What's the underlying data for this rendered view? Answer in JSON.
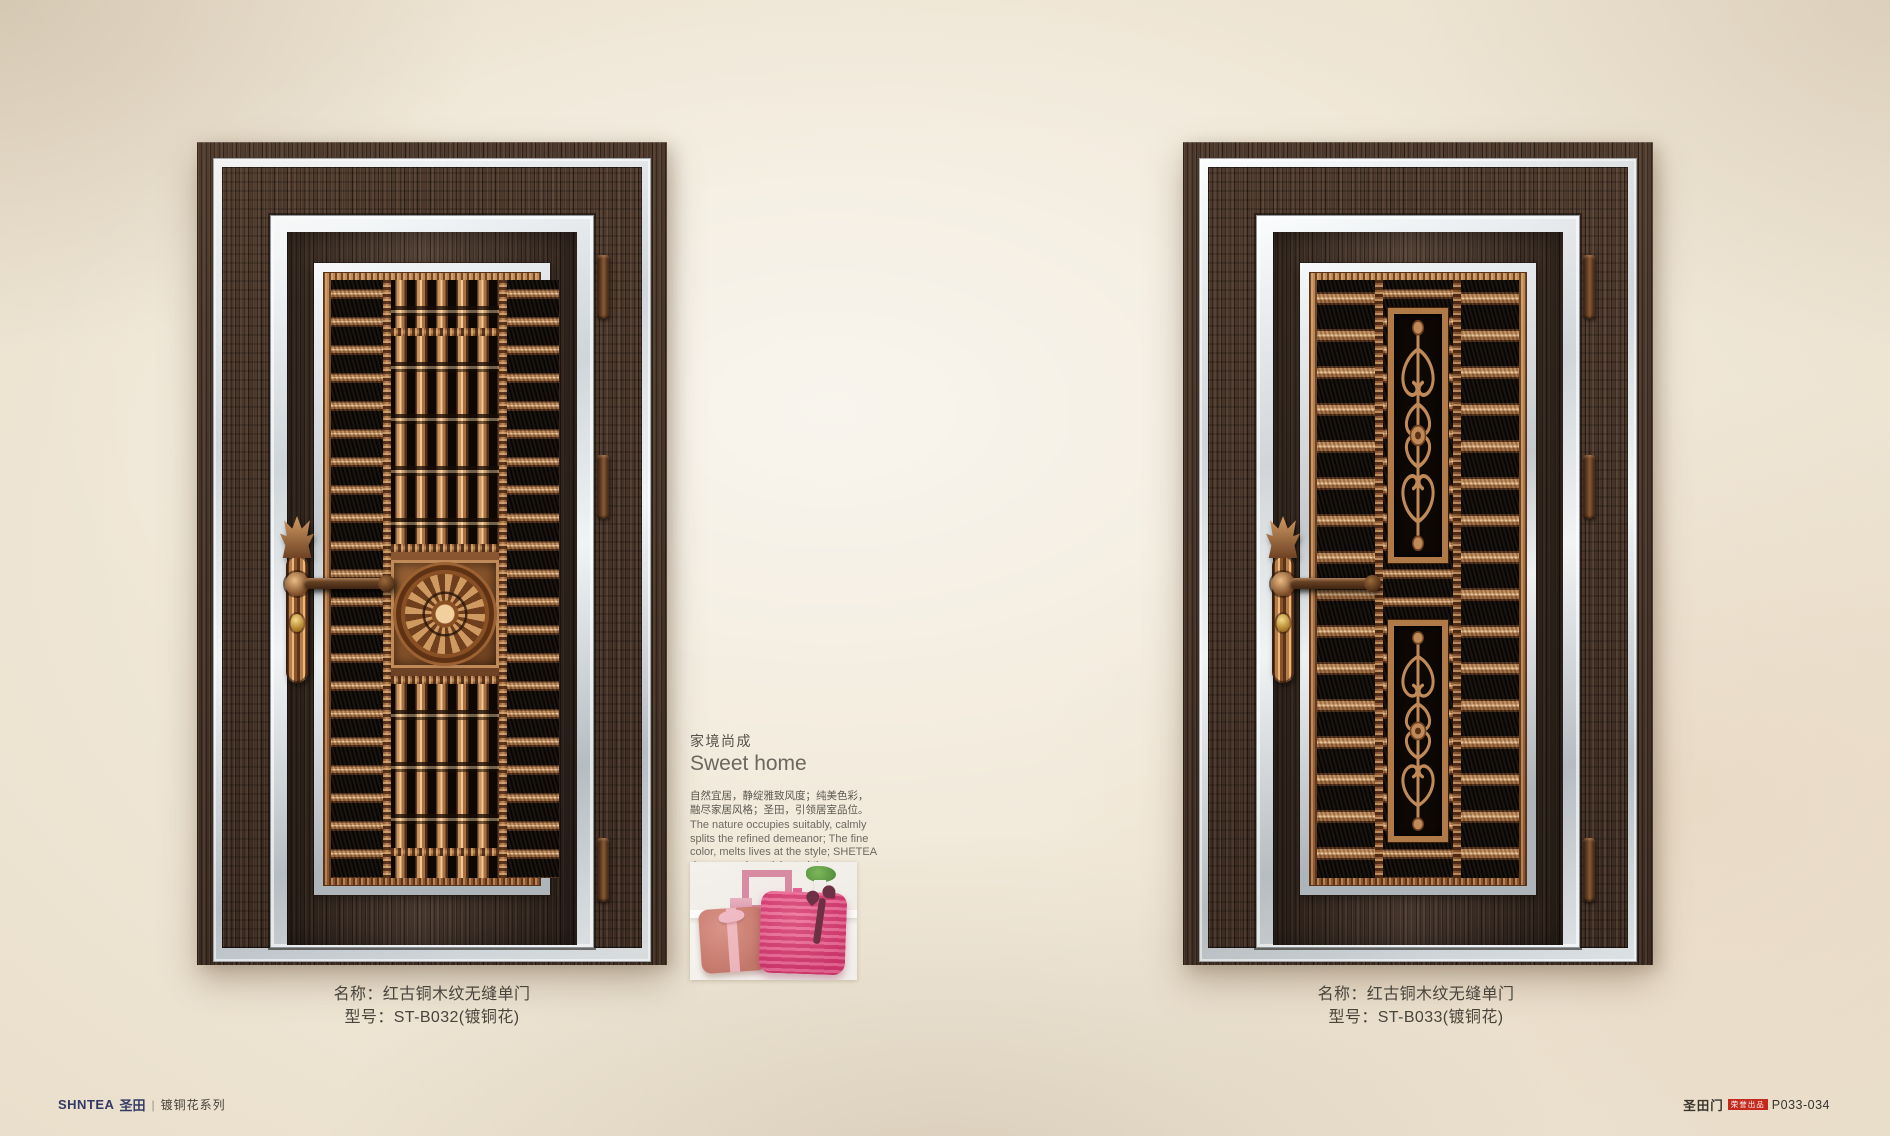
{
  "doors": [
    {
      "name_label": "名称：红古铜木纹无缝单门",
      "model_label": "型号：ST-B032(镀铜花)"
    },
    {
      "name_label": "名称：红古铜木纹无缝单门",
      "model_label": "型号：ST-B033(镀铜花)"
    }
  ],
  "intro": {
    "title_cn": "家境尚成",
    "title_en": "Sweet home",
    "desc_cn_line1": "自然宜居，静绽雅致风度；纯美色彩，",
    "desc_cn_line2": "融尽家居风格；圣田，引领居室品位。",
    "desc_en": "The nature occupies suitably, calmly splits the refined demeanor; The fine color, melts lives at the style; SHETEA door, eagerly anticipated the room personal status."
  },
  "footer": {
    "brand_en": "SHNTEA",
    "brand_cn": "圣田",
    "divider": "|",
    "series": "镀铜花系列",
    "publisher": "圣田门",
    "badge": "荣誉出品",
    "page_no": "P033-034"
  },
  "colors": {
    "wall": "#e9dfcc",
    "wood": "#3e2f26",
    "silver_trim": "#d8dde1",
    "copper": "#b5804e",
    "grille_background": "#0c0702",
    "badge_red": "#c5281c",
    "brand_navy": "#333a66"
  }
}
